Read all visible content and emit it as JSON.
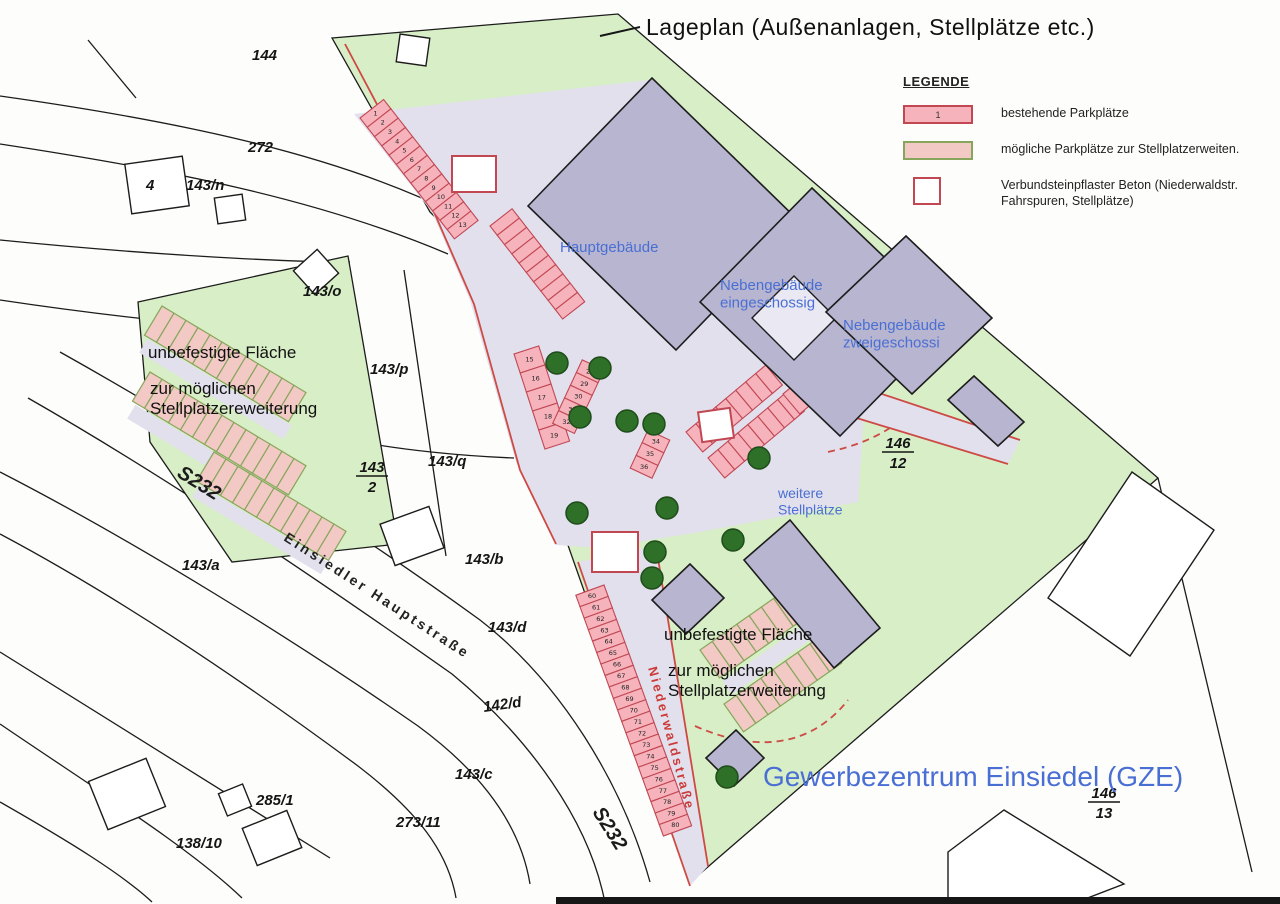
{
  "title": "Lageplan (Außenanlagen, Stellplätze etc.)",
  "legend": {
    "heading": "LEGENDE",
    "items": [
      {
        "key": "existing",
        "swatch_label": "1",
        "label": "bestehende Parkplätze"
      },
      {
        "key": "possible",
        "swatch_label": "",
        "label": "mögliche Parkplätze zur Stellplatzerweiten."
      },
      {
        "key": "paver",
        "swatch_label": "",
        "label": "Verbundsteinpflaster Beton (Niederwaldstr.\nFahrspuren, Stellplätze)"
      }
    ]
  },
  "colors": {
    "existing_stall": "#f6b3bb",
    "existing_border": "#c14753",
    "possible_stall": "#f2c9c5",
    "possible_border": "#87a65b",
    "green_area": "#d8eec6",
    "paved_area": "#e2e0ed",
    "building": "#b7b5cf",
    "blue_label": "#4a6fd4",
    "red_line": "#cd4a45"
  },
  "map": {
    "parcel_labels": [
      {
        "t": "144",
        "x": 252,
        "y": 60
      },
      {
        "t": "272",
        "x": 248,
        "y": 152
      },
      {
        "t": "143/n",
        "x": 186,
        "y": 190
      },
      {
        "t": "4",
        "x": 146,
        "y": 190,
        "size": 10
      },
      {
        "t": "143/o",
        "x": 303,
        "y": 296
      },
      {
        "t": "143/p",
        "x": 370,
        "y": 374
      },
      {
        "t": "143/q",
        "x": 428,
        "y": 466
      },
      {
        "t": "143/a",
        "x": 182,
        "y": 570
      },
      {
        "t": "143/b",
        "x": 465,
        "y": 564
      },
      {
        "t": "143/d",
        "x": 488,
        "y": 632
      },
      {
        "t": "142/d",
        "x": 484,
        "y": 712,
        "r": -8
      },
      {
        "t": "143/c",
        "x": 455,
        "y": 779
      },
      {
        "t": "285/1",
        "x": 256,
        "y": 805
      },
      {
        "t": "273/11",
        "x": 396,
        "y": 827
      },
      {
        "t": "138/10",
        "x": 176,
        "y": 848
      }
    ],
    "fraction_labels": [
      {
        "top": "143",
        "bot": "2",
        "x": 372,
        "y": 472
      },
      {
        "top": "146",
        "bot": "12",
        "x": 898,
        "y": 448
      },
      {
        "top": "146",
        "bot": "13",
        "x": 1104,
        "y": 798
      }
    ],
    "labels": [
      {
        "lines": [
          "Hauptgebäude"
        ],
        "x": 560,
        "y": 252,
        "cls": "blue",
        "size": 15
      },
      {
        "lines": [
          "Nebengebäude",
          "eingeschossig"
        ],
        "x": 720,
        "y": 290,
        "cls": "blue",
        "size": 15
      },
      {
        "lines": [
          "Nebengebäude",
          "zweigeschossi"
        ],
        "x": 843,
        "y": 330,
        "cls": "blue",
        "size": 15
      },
      {
        "lines": [
          "weitere",
          "Stellplätze"
        ],
        "x": 778,
        "y": 498,
        "cls": "blue",
        "size": 14
      },
      {
        "lines": [
          "Gewerbezentrum Einsiedel (GZE)"
        ],
        "x": 763,
        "y": 786,
        "cls": "blue",
        "size": 28
      },
      {
        "lines": [
          "unbefestigte Fläche"
        ],
        "x": 148,
        "y": 358,
        "cls": "note",
        "size": 17
      },
      {
        "lines": [
          "zur möglichen",
          "Stellplatzereweiterung"
        ],
        "x": 150,
        "y": 394,
        "cls": "note",
        "size": 17
      },
      {
        "lines": [
          "unbefestigte Fläche"
        ],
        "x": 664,
        "y": 640,
        "cls": "note",
        "size": 17
      },
      {
        "lines": [
          "zur möglichen",
          "Stellplatzerweiterung"
        ],
        "x": 668,
        "y": 676,
        "cls": "note",
        "size": 17
      },
      {
        "lines": [
          "Einsiedler Hauptstraße"
        ],
        "x": 283,
        "y": 540,
        "cls": "street",
        "size": 14,
        "r": 33
      },
      {
        "lines": [
          "Niederwaldstraße"
        ],
        "x": 648,
        "y": 668,
        "cls": "redstreet",
        "size": 13,
        "r": 75
      },
      {
        "lines": [
          "S232"
        ],
        "x": 176,
        "y": 476,
        "cls": "roadname",
        "size": 20,
        "r": 32
      },
      {
        "lines": [
          "S232"
        ],
        "x": 592,
        "y": 812,
        "cls": "roadname",
        "size": 20,
        "r": 58
      }
    ],
    "parking_rows": [
      {
        "type": "e",
        "x": 360,
        "y": 118,
        "a": 52,
        "s": 11.8,
        "d": 30,
        "n": 13,
        "f": -1,
        "labels": [
          "1",
          "2",
          "3",
          "4",
          "5",
          "6",
          "7",
          "8",
          "9",
          "10",
          "11",
          "12",
          "13"
        ]
      },
      {
        "type": "e",
        "x": 490,
        "y": 226,
        "a": 52,
        "s": 11.8,
        "d": 28,
        "n": 10,
        "f": -1,
        "labels": []
      },
      {
        "type": "e",
        "x": 514,
        "y": 354,
        "a": 72,
        "s": 20,
        "d": 26,
        "n": 5,
        "f": -1,
        "labels": [
          "15",
          "16",
          "17",
          "18",
          "19"
        ]
      },
      {
        "type": "e",
        "x": 604,
        "y": 370,
        "a": 115,
        "s": 14,
        "d": 24,
        "n": 5,
        "f": 1,
        "labels": [
          "28",
          "29",
          "30",
          "31",
          "32"
        ]
      },
      {
        "type": "e",
        "x": 648,
        "y": 430,
        "a": 115,
        "s": 14,
        "d": 24,
        "n": 3,
        "f": -1,
        "labels": [
          "34",
          "35",
          "36"
        ]
      },
      {
        "type": "e",
        "x": 686,
        "y": 432,
        "a": -40,
        "s": 13,
        "d": 26,
        "n": 8,
        "f": 1,
        "labels": []
      },
      {
        "type": "e",
        "x": 708,
        "y": 458,
        "a": -40,
        "s": 13,
        "d": 26,
        "n": 8,
        "f": 1,
        "labels": []
      },
      {
        "type": "e",
        "x": 783,
        "y": 394,
        "a": -40,
        "s": 13,
        "d": 26,
        "n": 7,
        "f": 1,
        "labels": []
      },
      {
        "type": "e",
        "x": 604,
        "y": 585,
        "a": 70,
        "s": 12.2,
        "d": 30,
        "n": 21,
        "f": 1,
        "labels": [
          "60",
          "61",
          "62",
          "63",
          "64",
          "65",
          "66",
          "67",
          "68",
          "69",
          "70",
          "71",
          "72",
          "73",
          "74",
          "75",
          "76",
          "77",
          "78",
          "79",
          "80"
        ]
      },
      {
        "type": "p",
        "x": 162,
        "y": 306,
        "a": 31,
        "s": 14,
        "d": 34,
        "n": 12,
        "f": 1,
        "labels": []
      },
      {
        "type": "p",
        "x": 150,
        "y": 372,
        "a": 31,
        "s": 14,
        "d": 34,
        "n": 13,
        "f": 1,
        "labels": []
      },
      {
        "type": "p",
        "x": 214,
        "y": 452,
        "a": 31,
        "s": 14,
        "d": 34,
        "n": 11,
        "f": 1,
        "labels": []
      },
      {
        "type": "p",
        "x": 700,
        "y": 650,
        "a": -35,
        "s": 15,
        "d": 34,
        "n": 8,
        "f": 1,
        "labels": []
      },
      {
        "type": "p",
        "x": 724,
        "y": 704,
        "a": -35,
        "s": 15,
        "d": 34,
        "n": 8,
        "f": 1,
        "labels": []
      }
    ],
    "trees": [
      [
        557,
        363
      ],
      [
        600,
        368
      ],
      [
        580,
        417
      ],
      [
        627,
        421
      ],
      [
        654,
        424
      ],
      [
        759,
        458
      ],
      [
        667,
        508
      ],
      [
        577,
        513
      ],
      [
        733,
        540
      ],
      [
        655,
        552
      ],
      [
        652,
        578
      ],
      [
        727,
        777
      ]
    ],
    "paver_squares": [
      {
        "x": 452,
        "y": 156,
        "w": 44,
        "h": 36
      },
      {
        "x": 592,
        "y": 532,
        "w": 46,
        "h": 40
      },
      {
        "x": 700,
        "y": 410,
        "w": 32,
        "h": 30,
        "r": -8
      }
    ]
  }
}
